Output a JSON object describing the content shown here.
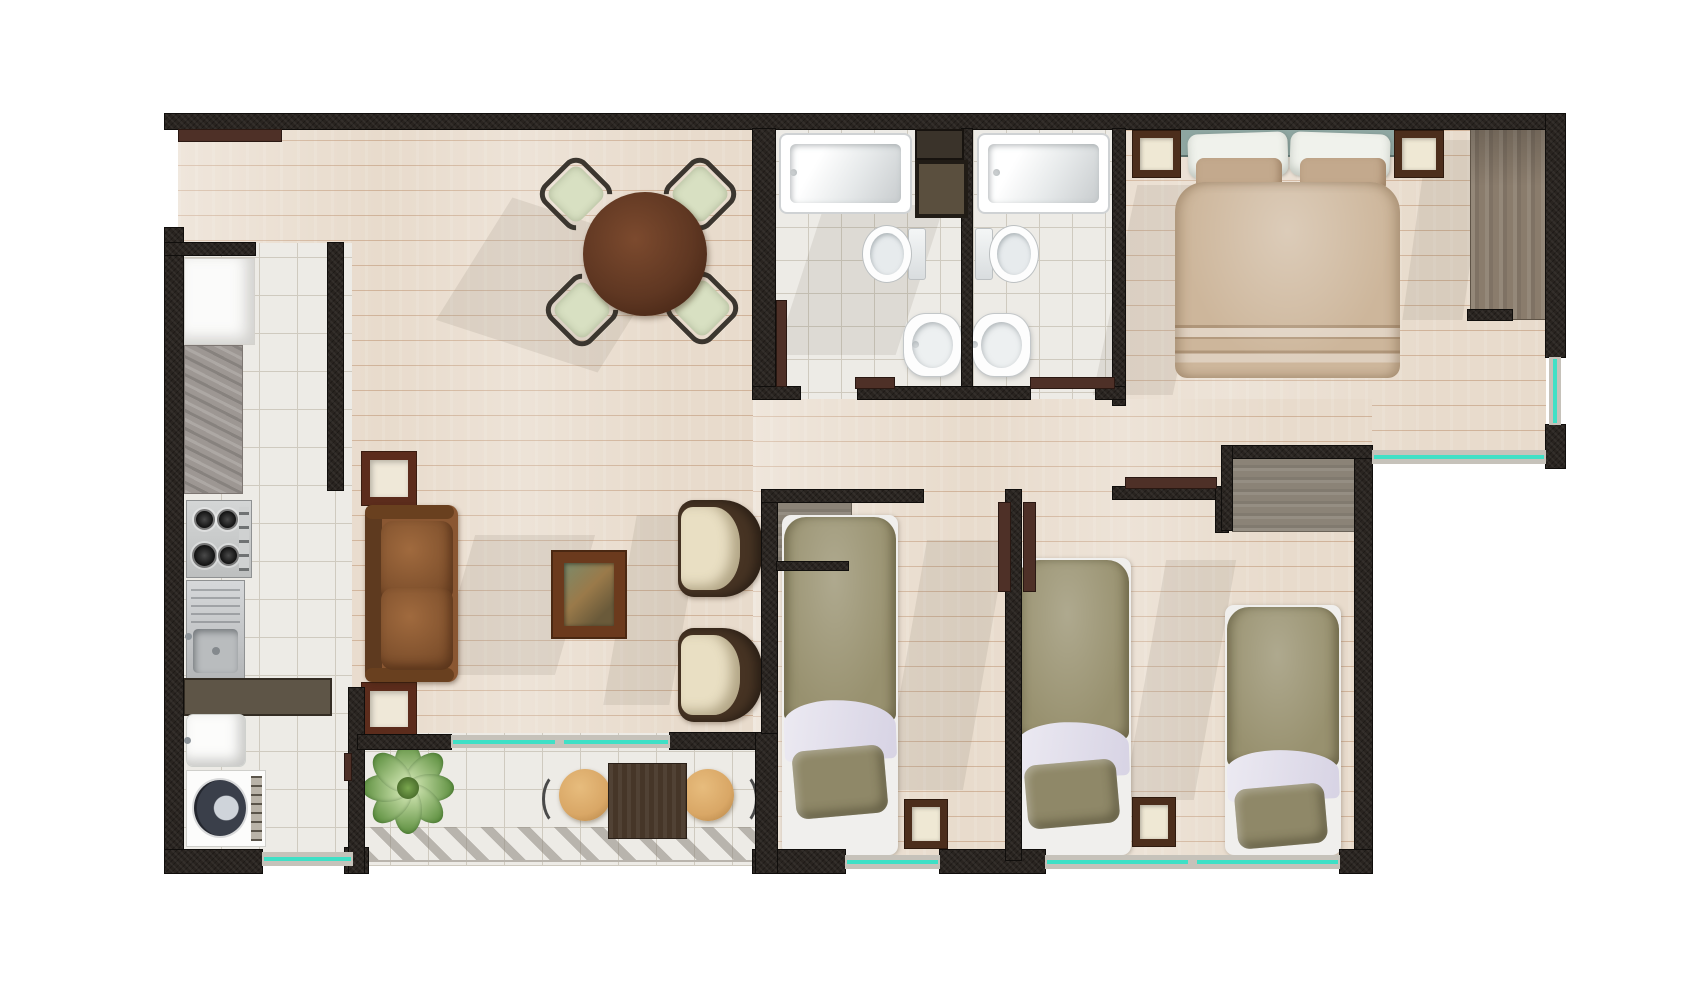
{
  "scene": "apartment-floor-plan-top-view",
  "palette": {
    "wall": "#292420",
    "wall_edge": "#100e0c",
    "wood_floor": "#e8dbcc",
    "wood_line": "#bd9270",
    "tile": "#edebe6",
    "tile_line": "#cfcabf",
    "glass": "#3fe0c6",
    "window_frame": "#c6c2ba",
    "door": "#4e3027",
    "granite": "#9d9793",
    "counter": "#5e5547",
    "sofa_leather": "#8a5732",
    "armchair_cream": "#e9dfc3",
    "armchair_frame": "#463323",
    "dining_table": "#5f3722",
    "dining_chair": "#d8e0c2",
    "chair_frame": "#3b362f",
    "end_table_frame": "#5c2c1c",
    "end_table_top": "#efe8d8",
    "bed_olive": "#98916f",
    "bed_sheet": "#e2dfea",
    "bed_mattress": "#f0efed",
    "master_blanket": "#cdb69b",
    "master_pillow_tan": "#c3a98d",
    "headboard_teal": "#8ea6a1",
    "wardrobe_wood": "#8a7c6c",
    "closet_wood": "#8b8377",
    "plant_green": "#5d8f3f",
    "plant_light": "#cde3ae",
    "balcony_table_wood": "#463628",
    "balcony_chair_wood": "#d9a766",
    "fixture_white": "#fdfdfd",
    "hatch_line": "#a9a49c",
    "shadow": "#6e6155"
  },
  "rooms": [
    {
      "id": "dining-area",
      "furniture": [
        {
          "item": "round-dining-table",
          "count": 1
        },
        {
          "item": "dining-chair",
          "count": 4
        }
      ]
    },
    {
      "id": "kitchen",
      "furniture": [
        {
          "item": "refrigerator",
          "count": 1
        },
        {
          "item": "granite-counter",
          "count": 1
        },
        {
          "item": "gas-stove",
          "count": 1
        },
        {
          "item": "kitchen-sink",
          "count": 1
        },
        {
          "item": "counter",
          "count": 1
        }
      ]
    },
    {
      "id": "laundry-area",
      "furniture": [
        {
          "item": "laundry-sink",
          "count": 1
        },
        {
          "item": "washing-machine",
          "count": 1
        }
      ]
    },
    {
      "id": "living-area",
      "furniture": [
        {
          "item": "sofa",
          "count": 1
        },
        {
          "item": "armchair",
          "count": 2
        },
        {
          "item": "coffee-table",
          "count": 1
        },
        {
          "item": "end-table",
          "count": 2
        }
      ]
    },
    {
      "id": "bathroom-1",
      "furniture": [
        {
          "item": "bathtub",
          "count": 1
        },
        {
          "item": "toilet",
          "count": 1
        },
        {
          "item": "pedestal-sink",
          "count": 1
        },
        {
          "item": "service-shaft",
          "count": 2
        }
      ]
    },
    {
      "id": "bathroom-2",
      "furniture": [
        {
          "item": "bathtub",
          "count": 1
        },
        {
          "item": "toilet",
          "count": 1
        },
        {
          "item": "pedestal-sink",
          "count": 1
        }
      ]
    },
    {
      "id": "master-bedroom",
      "furniture": [
        {
          "item": "double-bed",
          "count": 1
        },
        {
          "item": "nightstand",
          "count": 2
        },
        {
          "item": "wardrobe",
          "count": 1
        }
      ]
    },
    {
      "id": "bedroom-2",
      "furniture": [
        {
          "item": "single-bed",
          "count": 1
        },
        {
          "item": "nightstand",
          "count": 1
        },
        {
          "item": "closet",
          "count": 1
        }
      ]
    },
    {
      "id": "bedroom-3",
      "furniture": [
        {
          "item": "single-bed",
          "count": 2
        },
        {
          "item": "nightstand",
          "count": 1
        },
        {
          "item": "closet",
          "count": 1
        }
      ]
    },
    {
      "id": "balcony",
      "furniture": [
        {
          "item": "potted-plant",
          "count": 1
        },
        {
          "item": "bistro-table",
          "count": 1
        },
        {
          "item": "bistro-chair",
          "count": 2
        }
      ]
    }
  ],
  "openings": {
    "entry_door": 1,
    "interior_doors": 5,
    "windows": 6,
    "sliding_balcony_window": 1
  }
}
